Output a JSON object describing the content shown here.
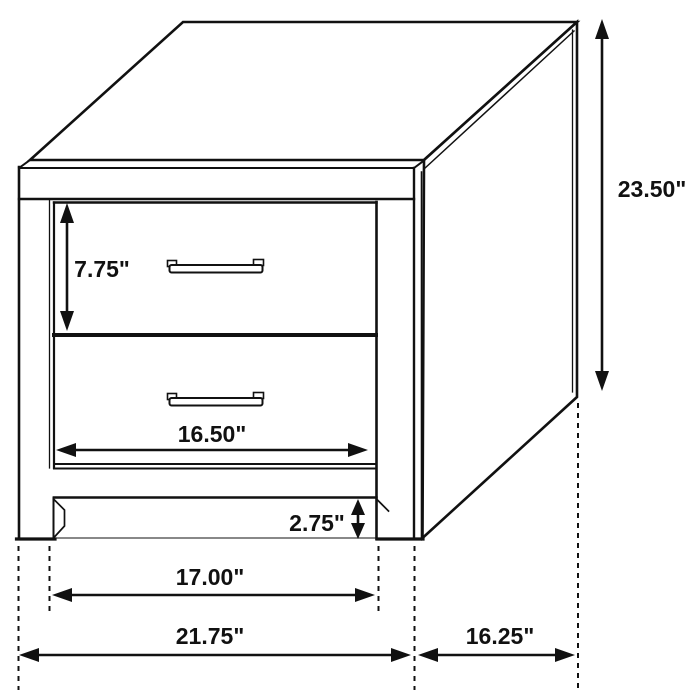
{
  "diagram": {
    "subject": "Two-drawer nightstand isometric dimension drawing",
    "unit": "inches",
    "dimensions": {
      "overall_height": "23.50\"",
      "top_drawer_height": "7.75\"",
      "drawer_front_width": "16.50\"",
      "leg_clearance_height": "2.75\"",
      "between_legs_width": "17.00\"",
      "overall_width": "21.75\"",
      "side_depth": "16.25\""
    },
    "colors": {
      "line": "#111111",
      "background": "#ffffff",
      "text": "#111111"
    }
  }
}
